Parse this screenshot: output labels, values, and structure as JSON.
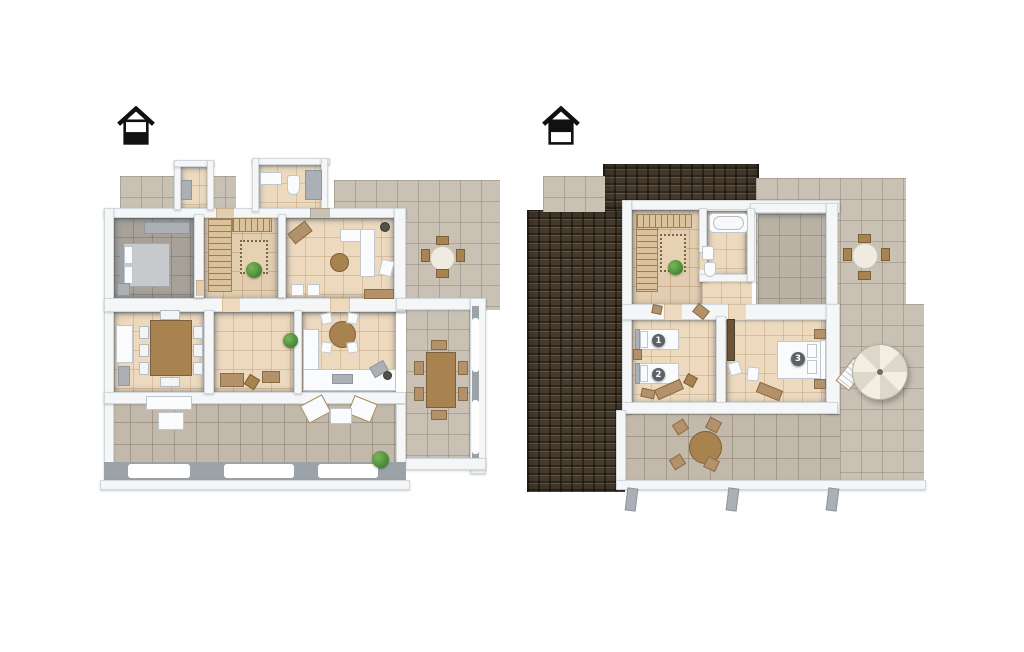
{
  "canvas": {
    "width": 1024,
    "height": 652,
    "background": "#ffffff"
  },
  "plans": [
    {
      "id": "ground-floor",
      "icon": "house-ground-floor-icon",
      "bed_badges": []
    },
    {
      "id": "upper-floor",
      "icon": "house-upper-floor-icon",
      "bed_badges": [
        "1",
        "2",
        "3"
      ]
    }
  ],
  "palette": {
    "wall_white": "#f4f6f8",
    "wall_edge": "#9aa2a9",
    "terrace_tile": "#c9c1b4",
    "interior_tile": "#ecd9be",
    "stair_tile": "#e2cdb0",
    "bedroom_floor": "#a7a199",
    "roof_brown": "#453a2c",
    "wood": "#a8834f",
    "dark_wood": "#7c5f3c",
    "white_furniture": "#fafbfc",
    "badge_bg": "#5b6167",
    "badge_text": "#ffffff",
    "plant_green": "#4e8f3a",
    "icon_black": "#111111"
  }
}
